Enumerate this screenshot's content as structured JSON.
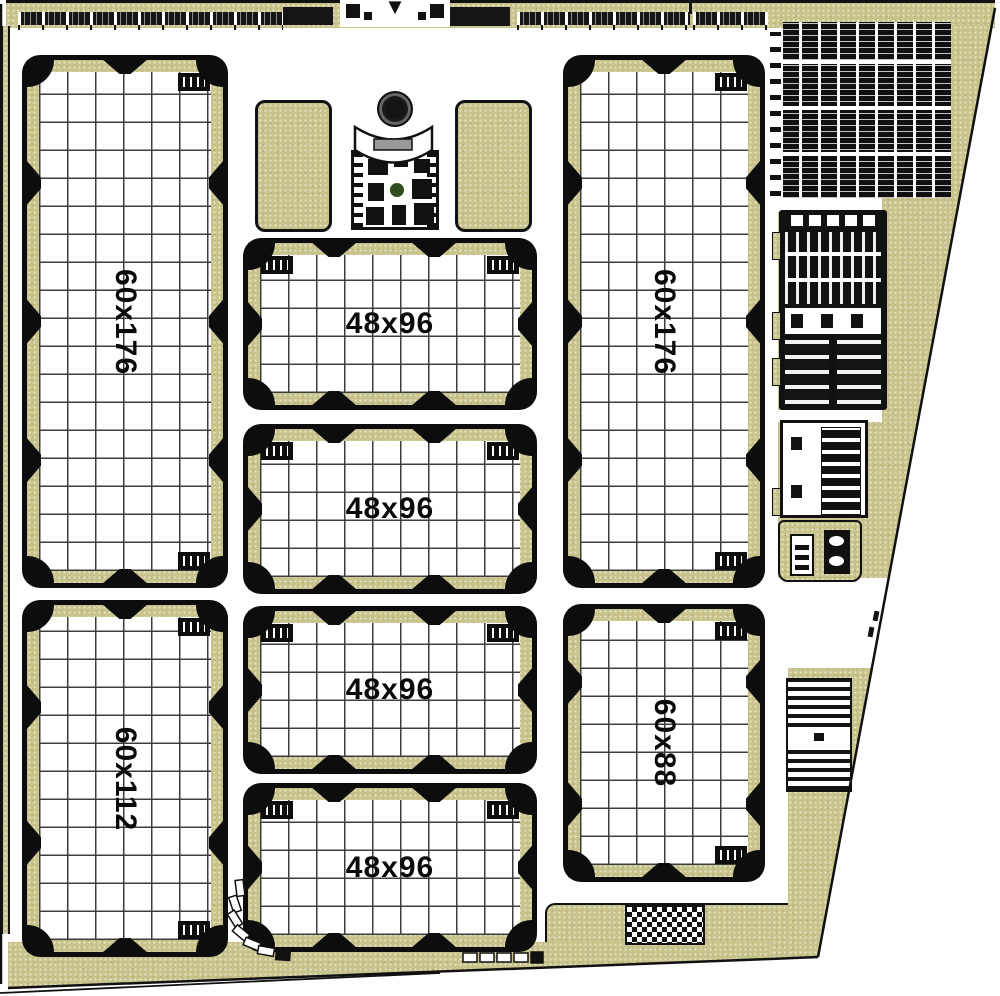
{
  "plan": {
    "type": "nursery-site-plan",
    "fields": [
      {
        "label": "60x176",
        "position": "west-upper",
        "orientation": "vertical"
      },
      {
        "label": "60x112",
        "position": "west-lower",
        "orientation": "vertical"
      },
      {
        "label": "48x96",
        "position": "center-1",
        "orientation": "horizontal"
      },
      {
        "label": "48x96",
        "position": "center-2",
        "orientation": "horizontal"
      },
      {
        "label": "48x96",
        "position": "center-3",
        "orientation": "horizontal"
      },
      {
        "label": "48x96",
        "position": "center-4",
        "orientation": "horizontal"
      },
      {
        "label": "60x176",
        "position": "east-upper",
        "orientation": "vertical"
      },
      {
        "label": "60x88",
        "position": "east-lower",
        "orientation": "vertical"
      }
    ],
    "entrance": {
      "arrow_glyph": "▼"
    },
    "colors": {
      "ground": "#c7c38a",
      "line": "#111111",
      "paper": "#ffffff",
      "plant_green": "#2f4d1d"
    }
  }
}
